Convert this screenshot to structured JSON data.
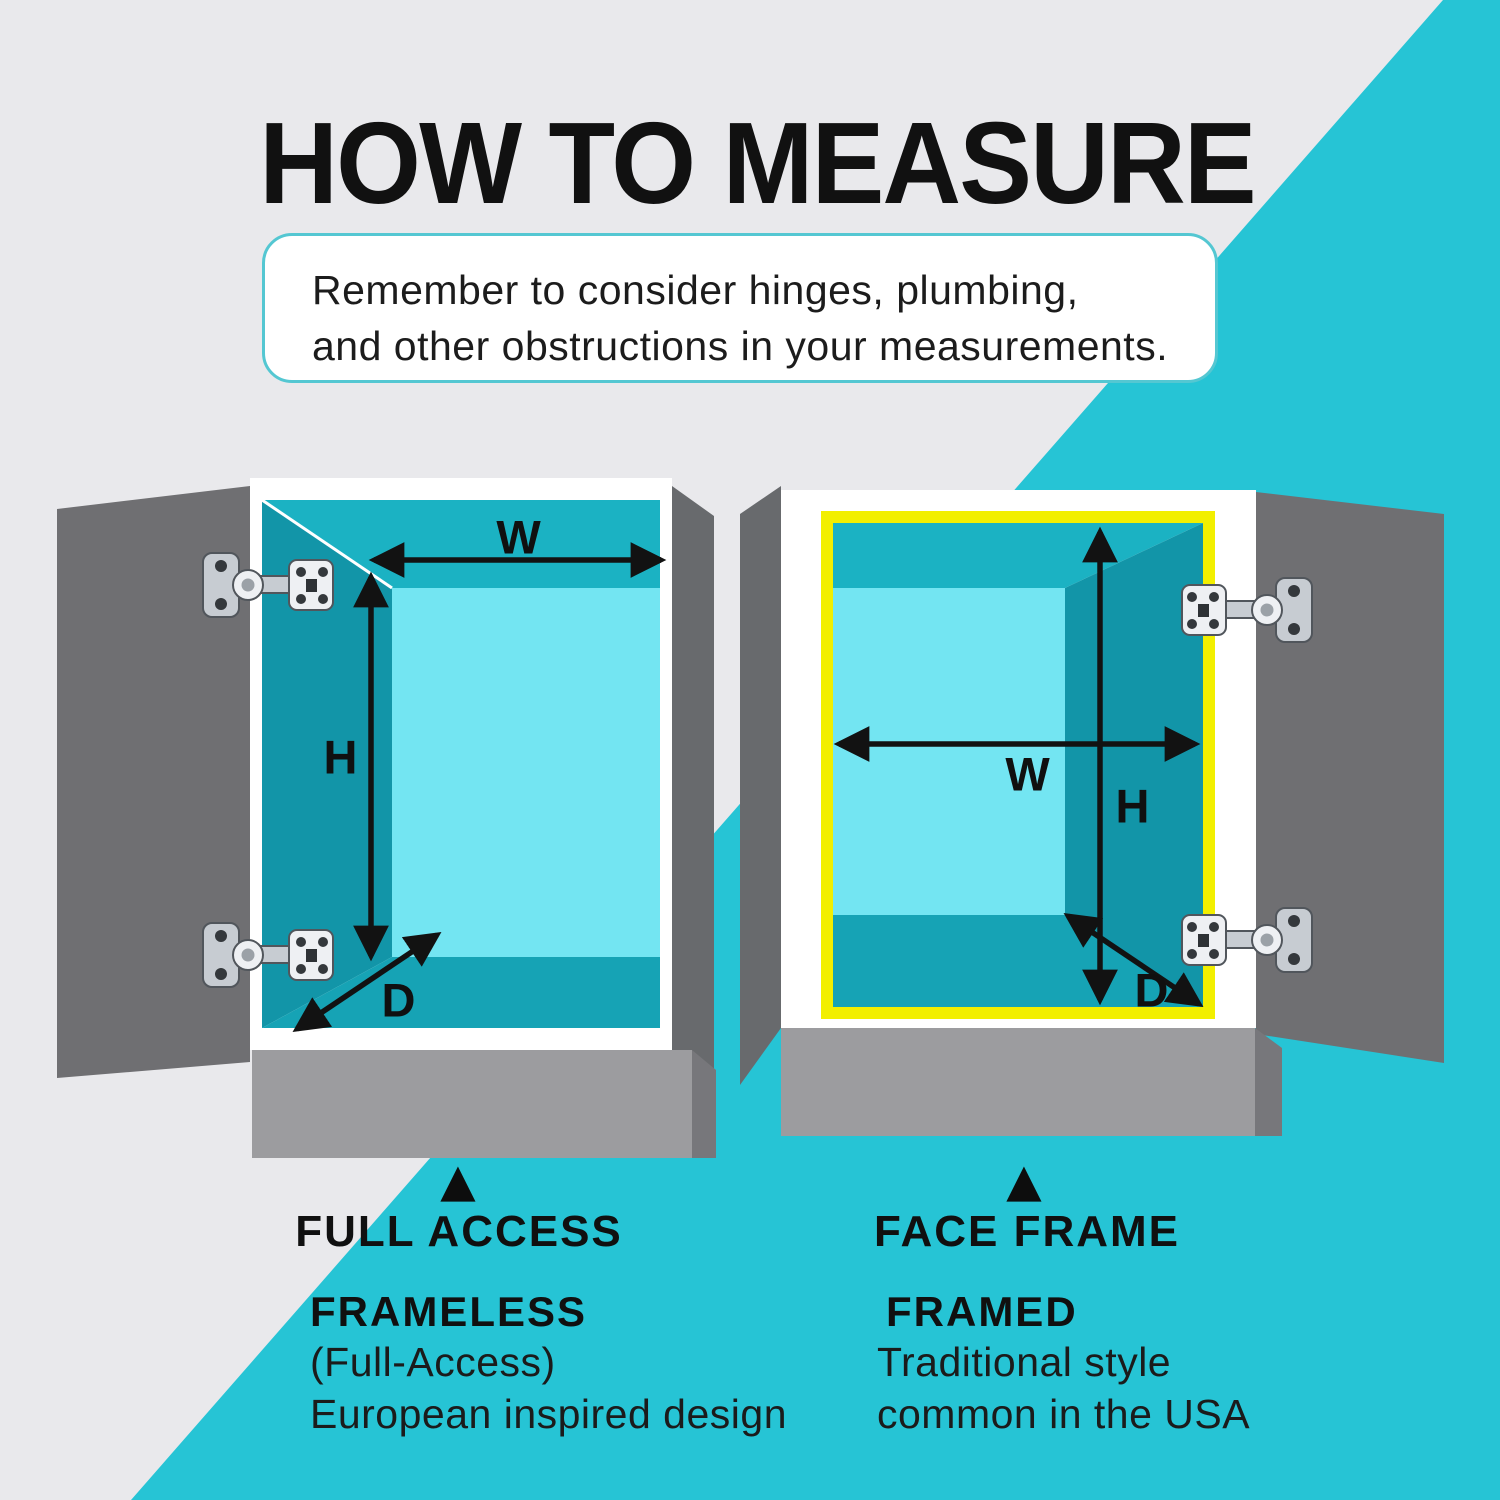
{
  "title": "HOW TO MEASURE",
  "note": {
    "line1": "Remember to consider hinges, plumbing,",
    "line2": "and other obstructions in your measurements."
  },
  "dimension_labels": {
    "width": "W",
    "height": "H",
    "depth": "D"
  },
  "legend": {
    "left": {
      "marker": "▲",
      "heading": "FULL ACCESS",
      "type": "FRAMELESS",
      "detail1": "(Full-Access)",
      "detail2": "European inspired design"
    },
    "right": {
      "marker": "▲",
      "heading": "FACE FRAME",
      "type": "FRAMED",
      "detail1": "Traditional style",
      "detail2": "common in the USA"
    }
  },
  "colors": {
    "bg": "#e9e9ec",
    "teal": "#26c4d5",
    "ink": "#161616",
    "white": "#ffffff",
    "door": "#6f6f72",
    "panel": "#686a6d",
    "base": "#9c9c9f",
    "baseDark": "#77777b",
    "ceiling": "#1bb2c3",
    "wallDark": "#1295a8",
    "wallBack": "#73e5f2",
    "floor": "#16a3b5",
    "yellow": "#f2ef00",
    "noteBorder": "#54c7d2"
  }
}
